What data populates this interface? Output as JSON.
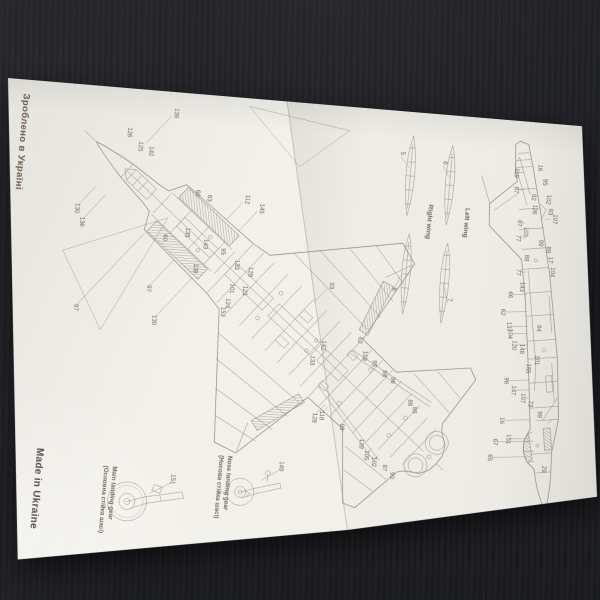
{
  "sheet": {
    "brand_top": "Зроблено в Україні",
    "brand_bottom": "Made in Ukraine"
  },
  "wing_details": {
    "right_wing_label": "Right wing",
    "left_wing_label": "Left wing",
    "callouts": [
      [
        "5",
        398,
        42,
        407,
        56
      ],
      [
        "6",
        441,
        48,
        448,
        62
      ],
      [
        "8",
        401,
        178,
        408,
        164
      ],
      [
        "7",
        457,
        184,
        451,
        169
      ]
    ]
  },
  "top_view": {
    "callouts": [
      [
        "139",
        169,
        21
      ],
      [
        "126",
        124,
        44
      ],
      [
        "125",
        136,
        57
      ],
      [
        "142",
        147,
        61
      ],
      [
        "130",
        78,
        124
      ],
      [
        "136",
        84,
        137
      ],
      [
        "60",
        197,
        99
      ],
      [
        "63",
        209,
        103
      ],
      [
        "112",
        247,
        101
      ],
      [
        "145",
        262,
        109
      ],
      [
        "135",
        190,
        139
      ],
      [
        "60",
        168,
        146
      ],
      [
        "143",
        209,
        149
      ],
      [
        "95",
        227,
        155
      ],
      [
        "133",
        242,
        167
      ],
      [
        "138",
        201,
        174
      ],
      [
        "129",
        256,
        173
      ],
      [
        "101",
        239,
        191
      ],
      [
        "123",
        252,
        192
      ],
      [
        "124",
        236,
        206
      ],
      [
        "153",
        232,
        215
      ],
      [
        "97",
        156,
        198
      ],
      [
        "130",
        164,
        229
      ],
      [
        "97",
        85,
        223
      ],
      [
        "93",
        338,
        180
      ],
      [
        "142",
        335,
        240
      ],
      [
        "133",
        325,
        256
      ],
      [
        "62",
        371,
        232
      ],
      [
        "103",
        377,
        247
      ],
      [
        "95",
        387,
        254
      ],
      [
        "98",
        398,
        263
      ],
      [
        "96",
        407,
        269
      ],
      [
        "118",
        339,
        310
      ],
      [
        "128",
        332,
        313
      ],
      [
        "88",
        426,
        290
      ],
      [
        "89",
        431,
        297
      ],
      [
        "99",
        360,
        320
      ],
      [
        "139",
        381,
        335
      ],
      [
        "105",
        387,
        346
      ],
      [
        "102",
        395,
        352
      ],
      [
        "87",
        406,
        357
      ],
      [
        "90",
        414,
        364
      ]
    ]
  },
  "side_view": {
    "callouts": [
      [
        "119",
        513,
        52
      ],
      [
        "16",
        536,
        45
      ],
      [
        "95",
        542,
        59
      ],
      [
        "87",
        514,
        69
      ],
      [
        "92",
        532,
        75
      ],
      [
        "102",
        547,
        76
      ],
      [
        "126",
        534,
        87
      ],
      [
        "93",
        550,
        88
      ],
      [
        "107",
        555,
        95
      ],
      [
        "87",
        520,
        102
      ],
      [
        "103",
        527,
        110
      ],
      [
        "77",
        520,
        117
      ],
      [
        "99",
        543,
        120
      ],
      [
        "89",
        551,
        126
      ],
      [
        "88",
        530,
        136
      ],
      [
        "17",
        554,
        136
      ],
      [
        "104",
        557,
        148
      ],
      [
        "77",
        523,
        151
      ],
      [
        "143",
        528,
        165
      ],
      [
        "66",
        517,
        174
      ],
      [
        "62",
        511,
        192
      ],
      [
        "137",
        518,
        206
      ],
      [
        "94",
        548,
        205
      ],
      [
        "104",
        520,
        213
      ],
      [
        "120",
        525,
        224
      ],
      [
        "148",
        533,
        227
      ],
      [
        "101",
        549,
        237
      ],
      [
        "155",
        541,
        246
      ],
      [
        "96",
        520,
        260
      ],
      [
        "147",
        528,
        269
      ],
      [
        "107",
        538,
        276
      ],
      [
        "73",
        546,
        281
      ],
      [
        "99",
        556,
        291
      ],
      [
        "16",
        519,
        300
      ],
      [
        "151",
        527,
        318
      ],
      [
        "67",
        514,
        322
      ],
      [
        "65",
        510,
        338
      ],
      [
        "29",
        565,
        345
      ]
    ]
  },
  "landing_gear": {
    "main": {
      "label_en": "Main landing gear",
      "label_uk": "(Основна стійка шасі)",
      "part": "151",
      "part_x": 196,
      "part_y": 386,
      "tx": 176,
      "ty": 402
    },
    "nose": {
      "label_en": "Nose landing gear",
      "label_uk": "(Носова стійка шасі)",
      "part": "149",
      "part_x": 303,
      "part_y": 364,
      "tx": 286,
      "ty": 380
    }
  },
  "colors": {
    "paper": "#f2f0ea",
    "desk": "#17181b",
    "ink": "#8f897f",
    "ink_dark": "#6e6961",
    "brand_cyr": "#6d5d50",
    "brand_eng": "#55524e"
  }
}
